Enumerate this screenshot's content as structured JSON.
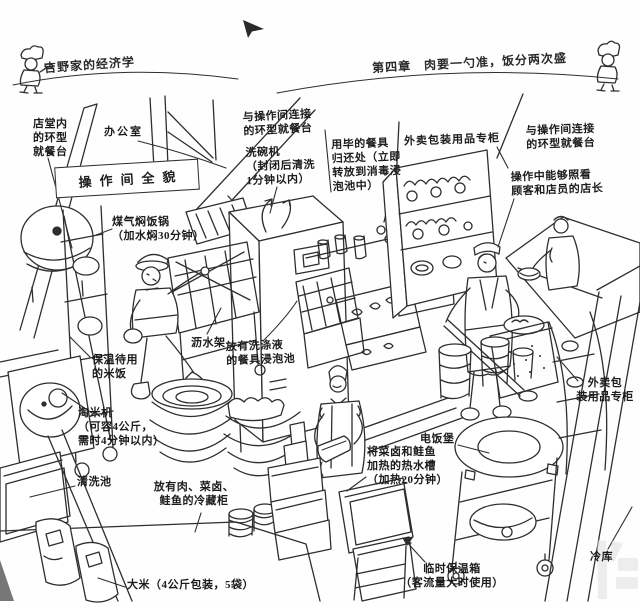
{
  "page": {
    "bg": "#ffffff",
    "ink": "#2e2e2e"
  },
  "header": {
    "book_title": "吉野家的经济学",
    "chapter_title": "第四章　肉要一勺准，饭分两次盛",
    "left_mascot_icon": "chef-icon",
    "right_mascot_icon": "chef-icon"
  },
  "diagram": {
    "title_box": "操作间全貌",
    "labels": {
      "ring_left": "店堂内\n的环型\n就餐台",
      "office": "办公室",
      "gas_pot": "煤气焖饭锅\n（加水焖30分钟）",
      "ring_mid": "与操作间连接\n的环型就餐台",
      "dishwasher": "洗碗机\n（封闭后清洗\n1分钟以内）",
      "return_station": "用毕的餐具\n归还处（立即\n转放到消毒浸\n泡池中）",
      "takeout_top": "外卖包装用品专柜",
      "ring_right": "与操作间连接\n的环型就餐台",
      "manager": "操作中能够照看\n顾客和店员的店长",
      "warm_rice": "保温待用\n的米饭",
      "drain_rack": "沥水架",
      "soak_sink": "放有洗涤液\n的餐具浸泡池",
      "rice_washer": "淘米机\n（可容4公斤，\n需时4分钟以内）",
      "wash_sink": "清洗池",
      "fridge": "放有肉、菜卤、\n鲑鱼的冷藏柜",
      "rice_bags": "大米（4公斤包装，5袋）",
      "rice_cooker": "电饭堡",
      "hot_tank": "将菜卤和鲑鱼\n加热的热水槽\n（加热20分钟）",
      "takeout_right": "外卖包\n装用品专柜",
      "temp_box": "临时保温箱\n（客流量大时使用）",
      "cold_storage": "冷库"
    }
  }
}
